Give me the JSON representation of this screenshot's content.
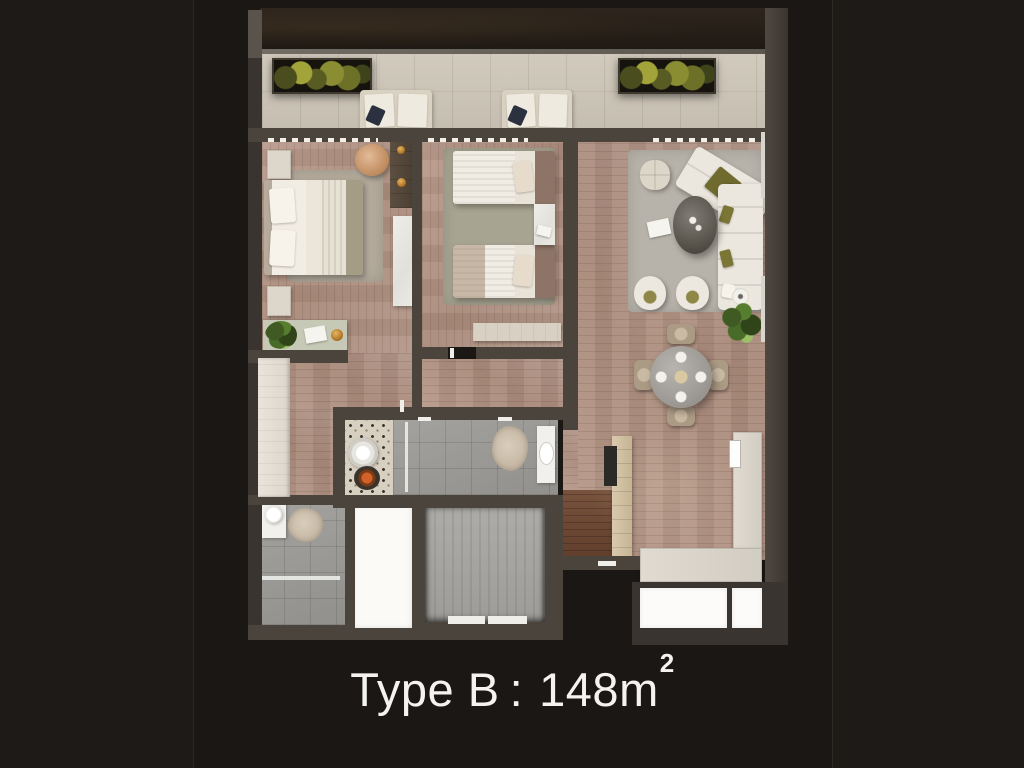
{
  "caption": {
    "type_label": "Type B",
    "separator": ":",
    "area_value": "148m",
    "area_exponent": "2"
  },
  "palette": {
    "background": "#1e1a17",
    "card": "#1b1714",
    "caption": "#f4f3f1",
    "wall": "#4a443d",
    "wall_dark": "#39342f",
    "wood_floor": "#b2948430",
    "wood_floor_main": "#b29484",
    "entry_wood_floor": "#6e4c3a",
    "balcony_tile": "#cdc6b8",
    "bathroom_tile": "#9b9a96",
    "living_rug": "#b7b3aa",
    "bedroom_rug": "#a8a492",
    "white_furniture": "#efece4",
    "olive_pillow": "#7c7635",
    "plant_green": "#577d2e",
    "copper_ottoman": "#c08b5f",
    "marble_table": "#9d9994",
    "void_white": "#fbfaf7"
  }
}
